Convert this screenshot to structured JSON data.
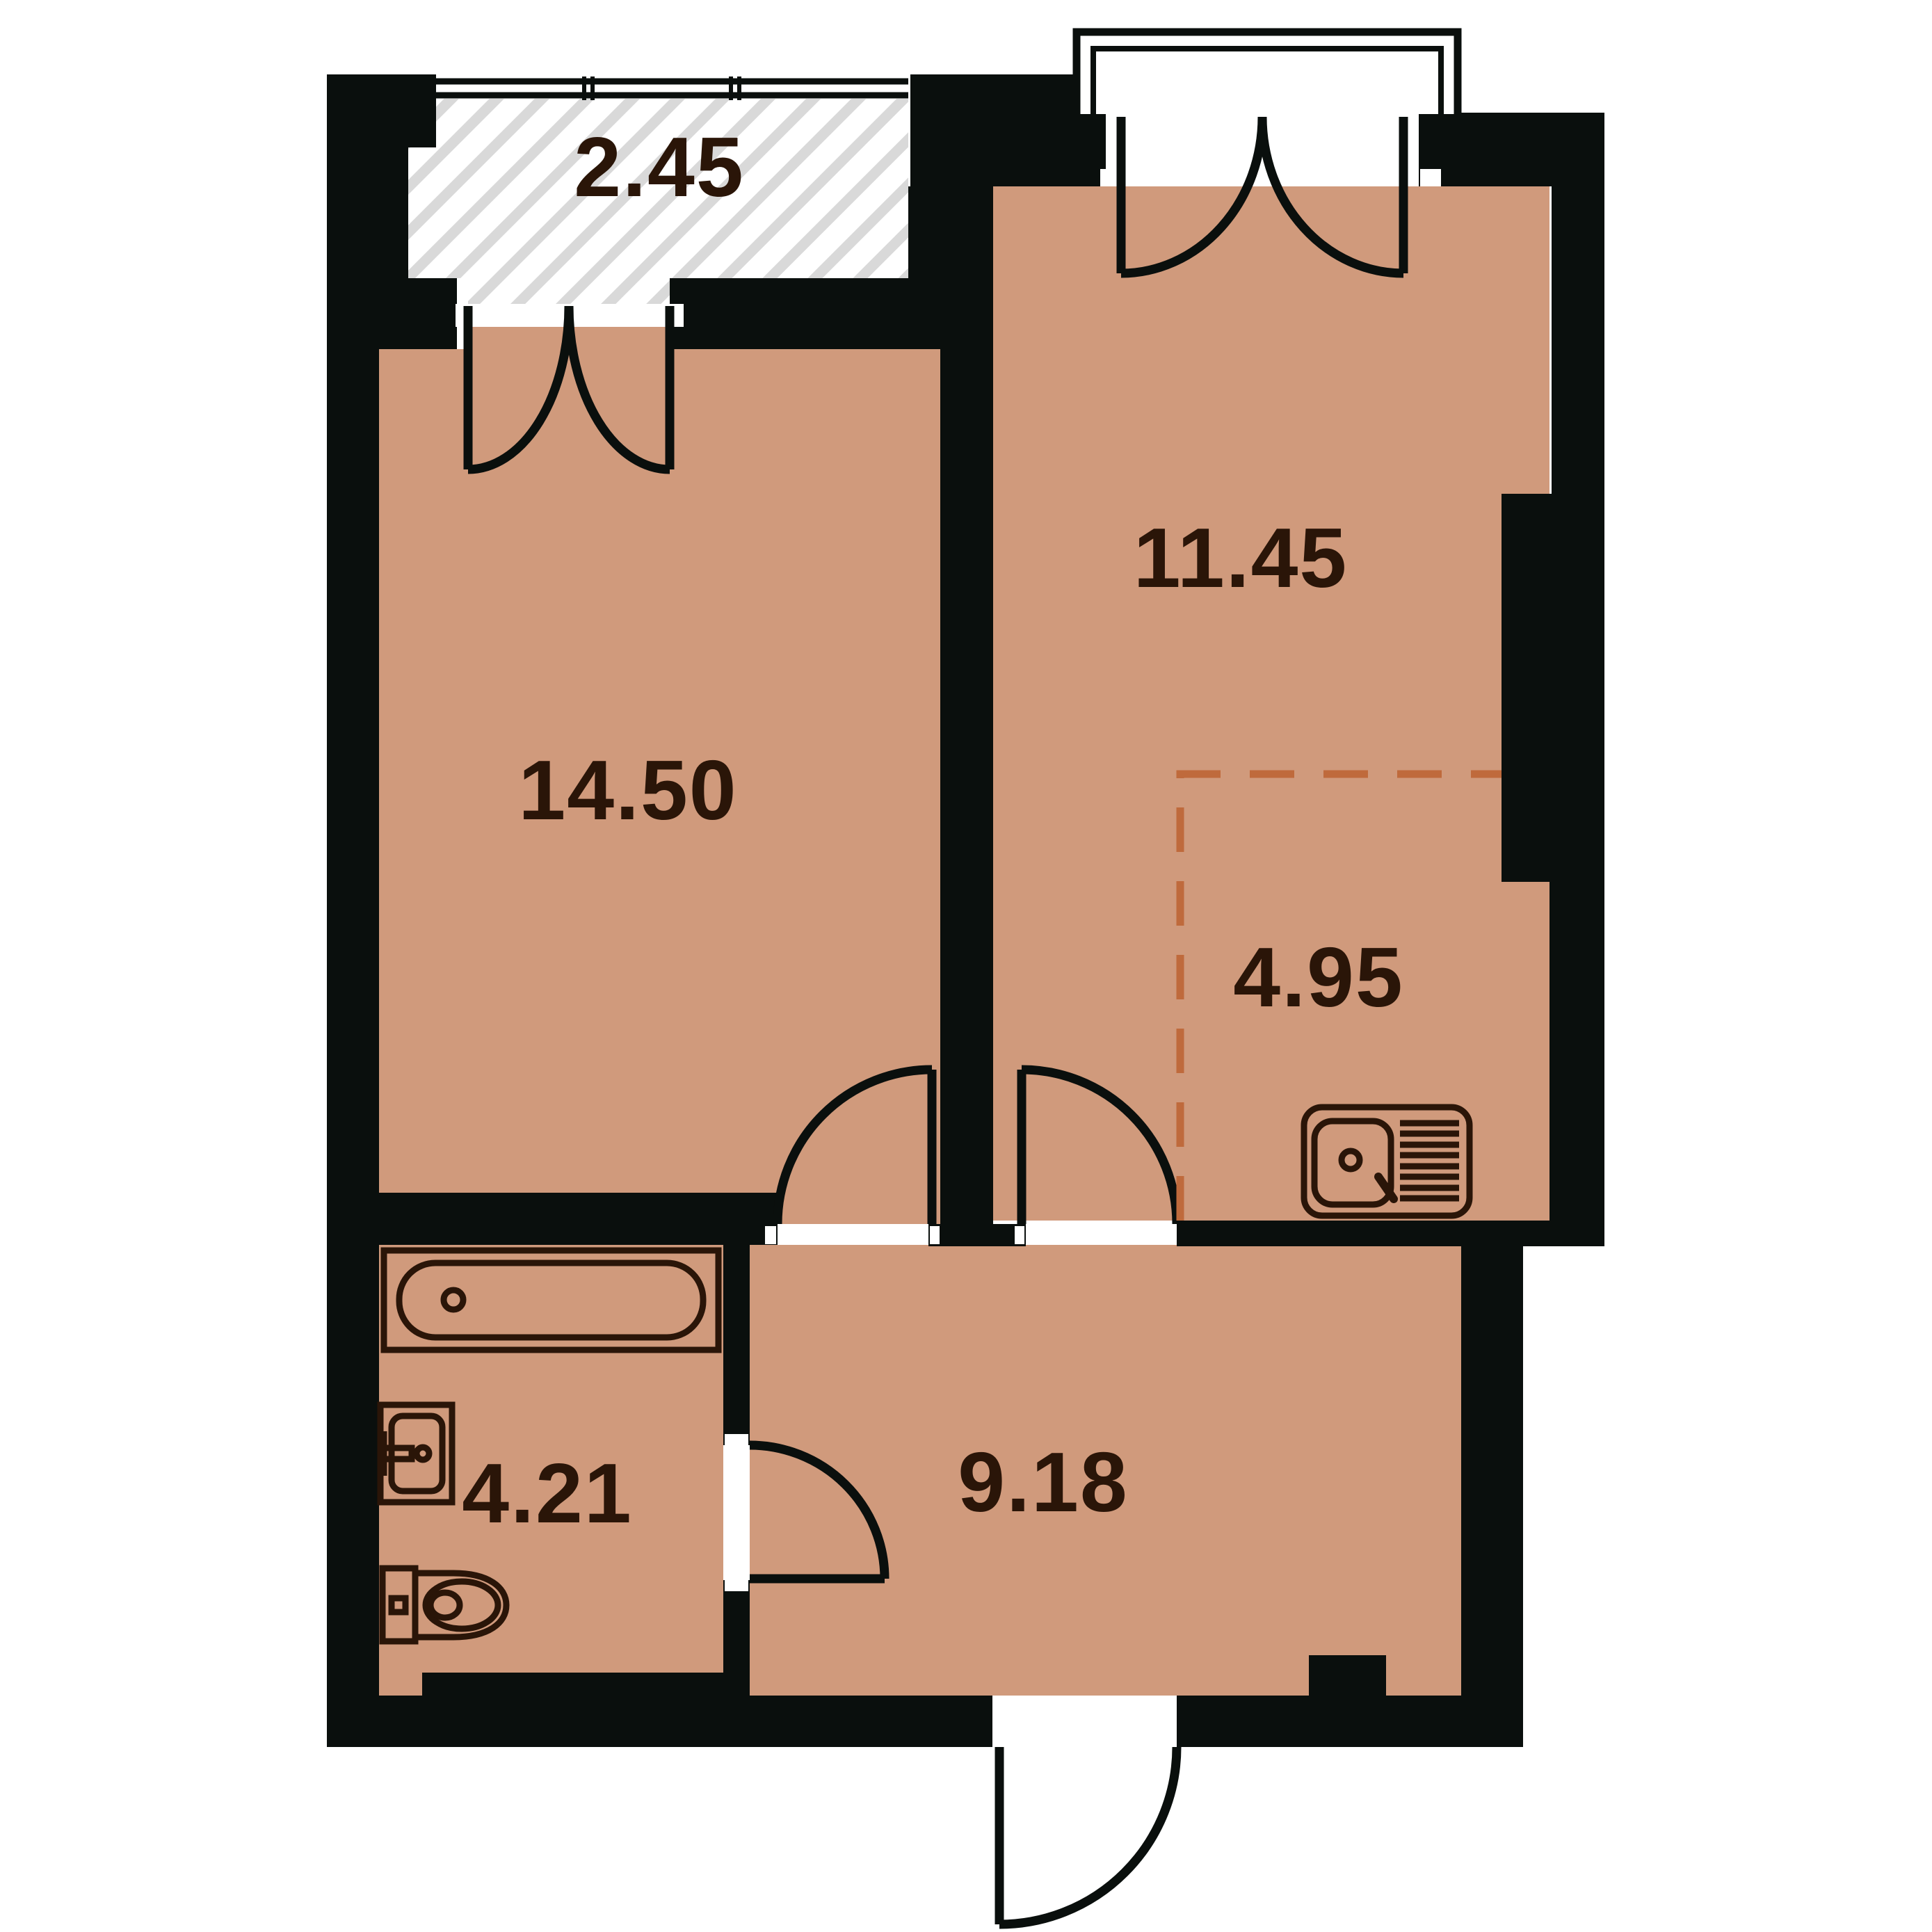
{
  "plan_title": "apartment-floor-plan",
  "colors": {
    "background": "#ffffff",
    "wall": "#0a0f0d",
    "floor": "#d09a7c",
    "hatch_stripe": "#d9d9d9",
    "door_line": "#0a0f0d",
    "fixture_line": "#2a1508",
    "label_text": "#2a1508",
    "kitchen_dash": "#bf6a3c"
  },
  "rooms": [
    {
      "name": "balcony",
      "area_label": "2.45"
    },
    {
      "name": "living-room",
      "area_label": "14.50"
    },
    {
      "name": "bedroom",
      "area_label": "11.45"
    },
    {
      "name": "kitchen-niche",
      "area_label": "4.95"
    },
    {
      "name": "bathroom",
      "area_label": "4.21"
    },
    {
      "name": "hallway",
      "area_label": "9.18"
    }
  ],
  "fixtures": [
    {
      "name": "bathtub"
    },
    {
      "name": "washbasin"
    },
    {
      "name": "toilet"
    },
    {
      "name": "kitchen-sink"
    }
  ],
  "features": [
    {
      "name": "balcony-window"
    },
    {
      "name": "balcony-french-door"
    },
    {
      "name": "bedroom-french-door"
    },
    {
      "name": "bedroom-balcony-railing"
    },
    {
      "name": "living-room-door"
    },
    {
      "name": "kitchen-door"
    },
    {
      "name": "bathroom-door"
    },
    {
      "name": "entrance-door"
    },
    {
      "name": "kitchen-zone-dashed-boundary"
    }
  ]
}
